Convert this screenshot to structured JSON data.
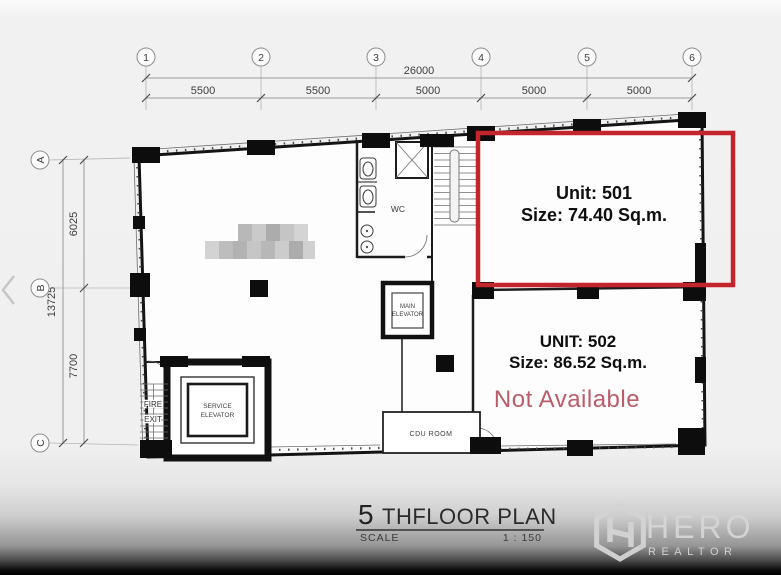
{
  "icons": {
    "carousel_prev": "chevron-left"
  },
  "grid": {
    "top": {
      "bubbles": [
        "1",
        "2",
        "3",
        "4",
        "5",
        "6"
      ],
      "total": "26000",
      "segments": [
        "5500",
        "5500",
        "5000",
        "5000",
        "5000"
      ]
    },
    "left": {
      "bubbles": [
        "A",
        "B",
        "C"
      ],
      "total": "13725",
      "segments": [
        "6025",
        "7700"
      ]
    }
  },
  "rooms": {
    "wc": "WC",
    "main_elevator_1": "MAIN",
    "main_elevator_2": "ELEVATOR",
    "service_elevator_1": "SERVICE",
    "service_elevator_2": "ELEVATOR",
    "fire_exit_1": "FIRE",
    "fire_exit_2": "EXIT",
    "cdu": "CDU ROOM"
  },
  "units": {
    "u501": {
      "name": "Unit: 501",
      "size": "Size: 74.40 Sq.m."
    },
    "u502": {
      "name": "UNIT: 502",
      "size": "Size: 86.52 Sq.m.",
      "status": "Not Available"
    }
  },
  "titleblock": {
    "floor_number": "5",
    "floor_label": "THFLOOR PLAN",
    "scale_label": "SCALE",
    "scale_value": "1 : 150"
  },
  "watermark": {
    "brand": "HERO",
    "tagline": "REALTOR"
  },
  "colors": {
    "highlight": "#c4242b",
    "status_text": "#bb5c69",
    "walls": "#141414",
    "watermark": "#d6d6d6"
  }
}
